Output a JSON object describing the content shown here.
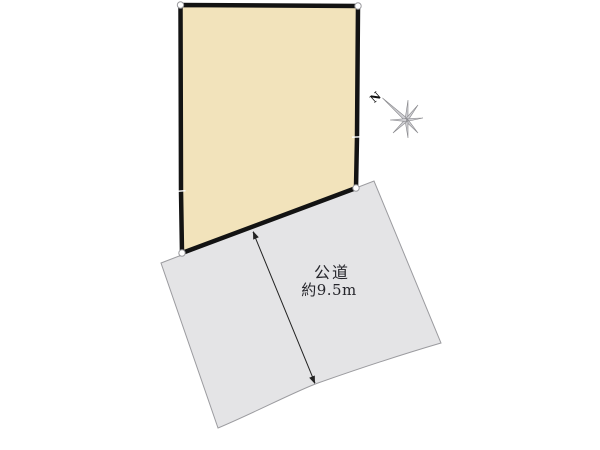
{
  "page": {
    "background": "#ffffff"
  },
  "plot": {
    "fill": "#f2e3bb",
    "border_color": "#131313"
  },
  "road": {
    "fill": "#e4e4e6",
    "border_color": "#9b9b9f",
    "label": "公道",
    "width_label": "約9.5m",
    "text_color": "#25252b"
  },
  "dimension_arrow": {
    "color": "#222222"
  },
  "compass": {
    "north_label": "N",
    "ray_fill": "#d0d0d4",
    "ray_stroke": "#87878b",
    "label_color": "#111111"
  },
  "corner_marker": {
    "fill": "#ffffff",
    "stroke": "#9a9a9e"
  }
}
